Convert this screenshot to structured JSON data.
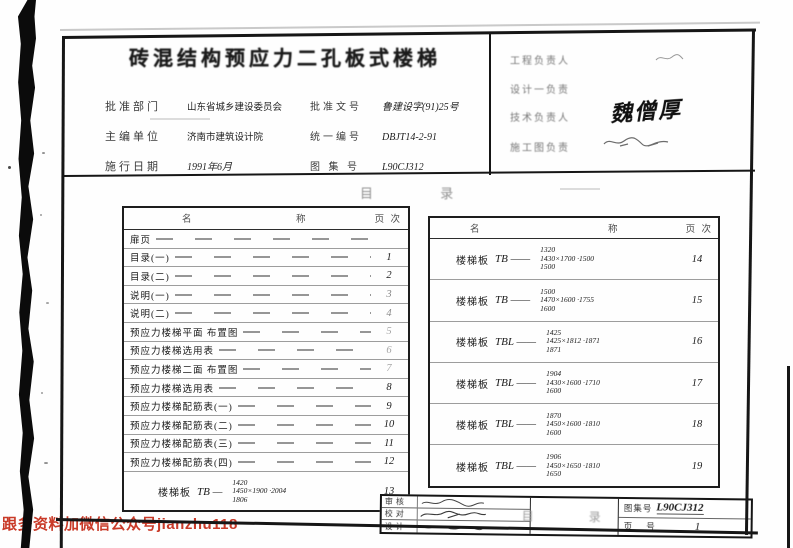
{
  "watermark": {
    "text": "跟多资料加微信公众号jianzhu118",
    "color": "#c93a28"
  },
  "header": {
    "title": "砖混结构预应力二孔板式楼梯",
    "fields_left": [
      {
        "label": "批准部门",
        "value": "山东省城乡建设委员会"
      },
      {
        "label": "主编单位",
        "value": "济南市建筑设计院"
      },
      {
        "label": "施行日期",
        "value": "1991年6月"
      }
    ],
    "fields_mid": [
      {
        "label": "批准文号",
        "value": "鲁建设字(91)25号"
      },
      {
        "label": "统一编号",
        "value": "DBJT14-2-91"
      },
      {
        "label": "图 集 号",
        "value": "L90CJ312"
      }
    ],
    "fields_right": [
      {
        "label": "工程负责人",
        "value": ""
      },
      {
        "label": "设计一负责",
        "value": ""
      },
      {
        "label": "技术负责人",
        "value": "魏僧厚"
      },
      {
        "label": "施工图负责",
        "value": ""
      }
    ]
  },
  "section_heading": "目 录",
  "toc_left": {
    "header": {
      "name_a": "名",
      "name_b": "称",
      "page": "页 次"
    },
    "rows": [
      {
        "name": "扉页",
        "page": ""
      },
      {
        "name": "目录(一)",
        "page": "1"
      },
      {
        "name": "目录(二)",
        "page": "2"
      },
      {
        "name": "说明(一)",
        "page": "3"
      },
      {
        "name": "说明(二)",
        "page": "4"
      },
      {
        "name": "预应力楼梯平面 布置图",
        "page": "5"
      },
      {
        "name": "预应力楼梯选用表",
        "page": "6"
      },
      {
        "name": "预应力楼梯二面 布置图",
        "page": "7"
      },
      {
        "name": "预应力楼梯选用表",
        "page": "8"
      },
      {
        "name": "预应力楼梯配筋表(一)",
        "page": "9"
      },
      {
        "name": "预应力楼梯配筋表(二)",
        "page": "10"
      },
      {
        "name": "预应力楼梯配筋表(三)",
        "page": "11"
      },
      {
        "name": "预应力楼梯配筋表(四)",
        "page": "12"
      }
    ],
    "tall_row": {
      "prefix": "楼梯板",
      "model": "TB —",
      "stack": [
        "1420",
        "1450×1900 ·2004",
        "1806"
      ],
      "page": "13"
    }
  },
  "toc_right": {
    "header": {
      "name_a": "名",
      "name_b": "称",
      "page": "页 次"
    },
    "rows": [
      {
        "prefix": "楼梯板",
        "model": "TB ——",
        "stack": [
          "1320",
          "1430×1700 ·1500",
          "1500"
        ],
        "page": "14"
      },
      {
        "prefix": "楼梯板",
        "model": "TB ——",
        "stack": [
          "1500",
          "1470×1600 ·1755",
          "1600"
        ],
        "page": "15"
      },
      {
        "prefix": "楼梯板",
        "model": "TBL ——",
        "stack": [
          "1425",
          "1425×1812 ·1871",
          "1871"
        ],
        "page": "16"
      },
      {
        "prefix": "楼梯板",
        "model": "TBL ——",
        "stack": [
          "1904",
          "1430×1600 ·1710",
          "1600"
        ],
        "page": "17"
      },
      {
        "prefix": "楼梯板",
        "model": "TBL ——",
        "stack": [
          "1870",
          "1450×1600 ·1810",
          "1600"
        ],
        "page": "18"
      },
      {
        "prefix": "楼梯板",
        "model": "TBL ——",
        "stack": [
          "1906",
          "1450×1650 ·1810",
          "1650"
        ],
        "page": "19"
      }
    ]
  },
  "titleblock": {
    "left_rows": [
      {
        "label": "审核"
      },
      {
        "label": "校对"
      },
      {
        "label": "设计"
      }
    ],
    "center": "目 录",
    "atlas": {
      "label": "图集号",
      "value": "L90CJ312"
    },
    "page_no": {
      "label": "页 号",
      "value": "1"
    }
  }
}
